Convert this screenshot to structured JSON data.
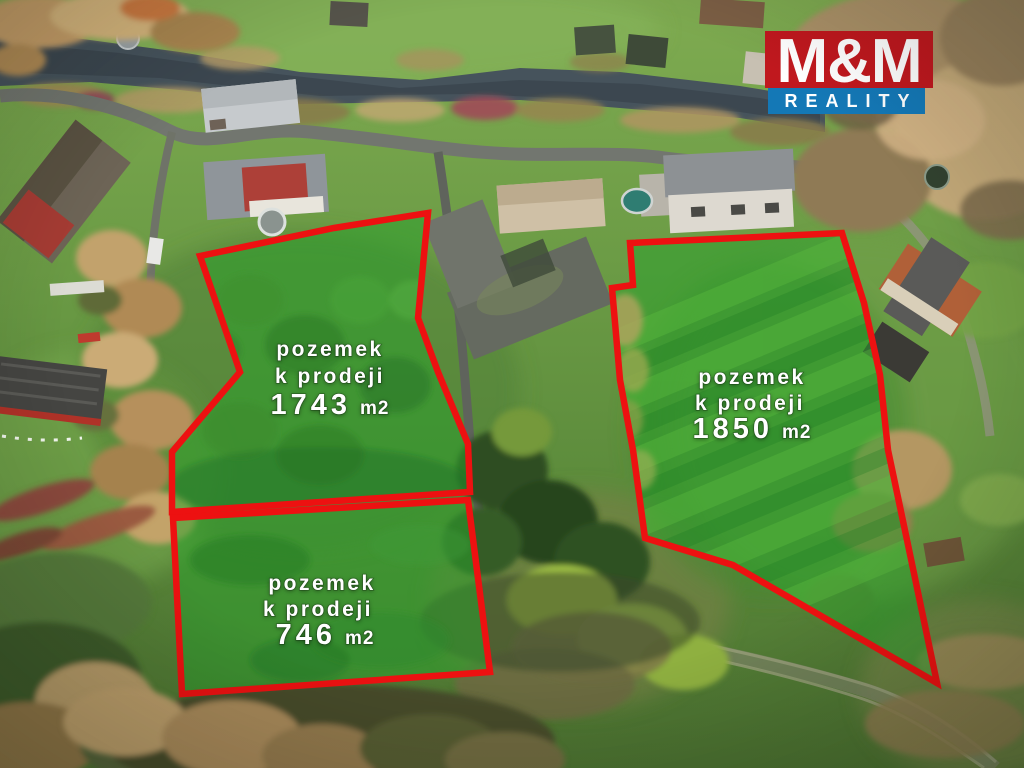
{
  "watermark": {
    "brand_top": "M&M",
    "brand_bottom": "REALITY"
  },
  "plots": [
    {
      "id": "plot-1743",
      "label_line1": "pozemek",
      "label_line2": "k prodeji",
      "area": "1743",
      "unit": "m2",
      "points": "200,256 334,228 428,213 418,318 438,372 468,444 470,492 172,512 172,452 240,372"
    },
    {
      "id": "plot-1850",
      "label_line1": "pozemek",
      "label_line2": "k prodeji",
      "area": "1850",
      "unit": "m2",
      "points": "630,243 842,233 864,303 880,375 888,450 907,540 937,683 733,565 645,538 633,450 620,380 612,288 633,285"
    },
    {
      "id": "plot-746",
      "label_line1": "pozemek",
      "label_line2": "k prodeji",
      "area": "746",
      "unit": "m2",
      "points": "173,518 468,500 490,672 182,694"
    }
  ],
  "colors": {
    "plot_outline": "#ed1111",
    "plot_fill": "#2aa12c",
    "label_text": "#ffffff",
    "logo_red": "#c0181e",
    "logo_blue": "#1478b6",
    "logo_text": "#ffffff"
  }
}
